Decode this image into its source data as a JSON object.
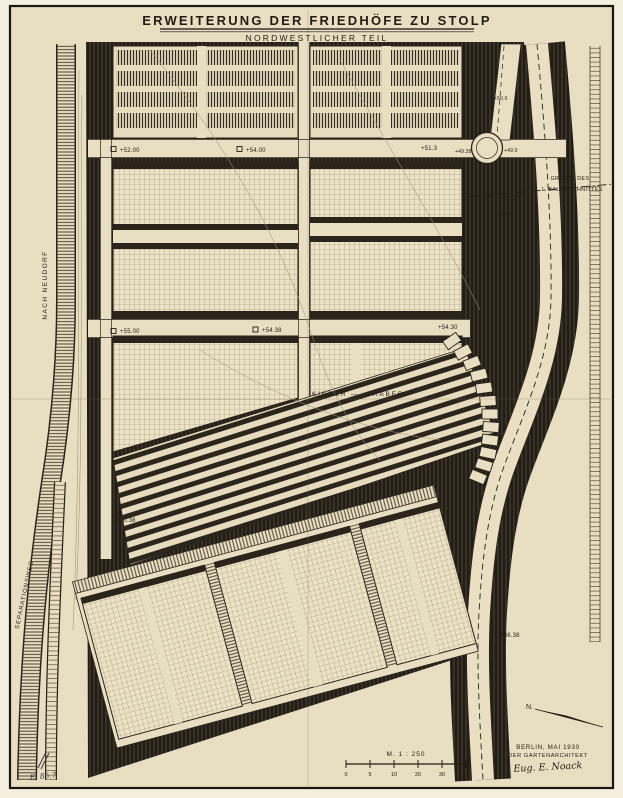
{
  "title": "ERWEITERUNG DER FRIEDHÖFE ZU STOLP",
  "subtitle": "NORDWESTLICHER TEIL",
  "labels": {
    "road_left": "NACH NEUDORF",
    "path_left": "SEPARATIONSWEG",
    "boundary1": "GRENZE DES",
    "boundary2": "1. BAUABSCHNITTES",
    "kinder": "KINDER —",
    "graeber": "GRÄBER",
    "north": "N."
  },
  "elevations": [
    "+52.00",
    "+54.00",
    "+51.3",
    "+49.38",
    "+49.0",
    "+50.0",
    "+48.0",
    "+55.00",
    "+54.38",
    "+54.30",
    "+50.38",
    "+46.38"
  ],
  "scale": {
    "label": "M. 1 : 250",
    "ticks": [
      "0",
      "5",
      "10",
      "20",
      "30",
      "40"
    ]
  },
  "imprint": {
    "city_date": "BERLIN, MAI 1930",
    "role": "DER GARTENARCHITEKT",
    "signature": "Eug. E. Noack"
  },
  "archive_mark": "E. 85.7",
  "colors": {
    "paper": "#e8dec2",
    "ink": "#221d13",
    "dark_planting": "#221d14"
  }
}
